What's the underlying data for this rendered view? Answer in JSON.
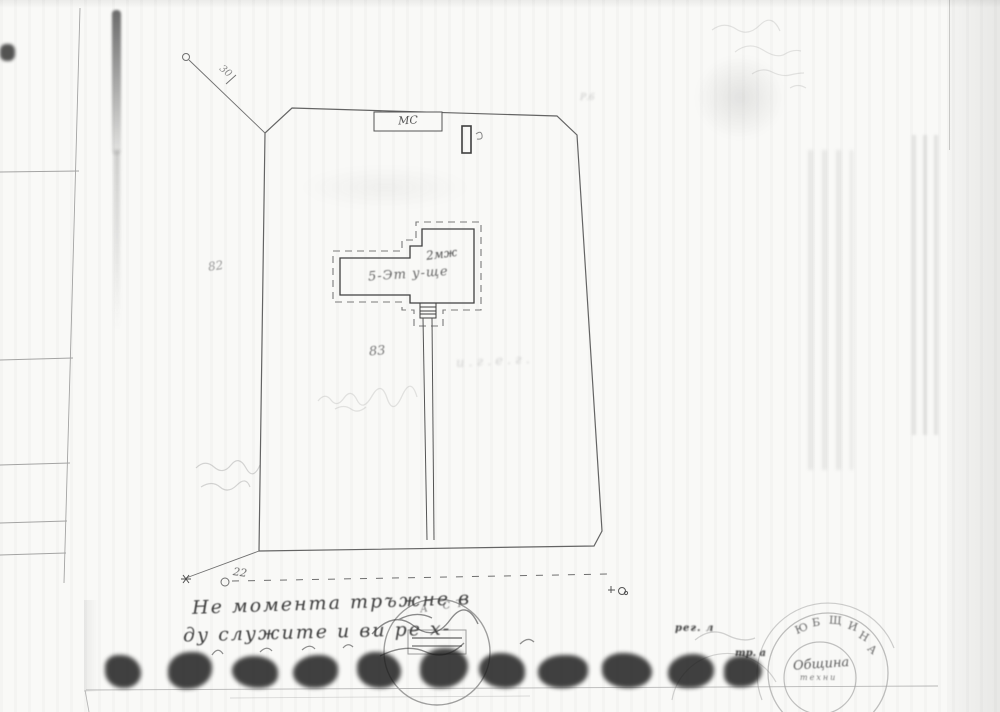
{
  "colors": {
    "paper": "#f9f9f7",
    "ink": "#3f3f3f",
    "faint_ink": "#9a9a9a"
  },
  "plan": {
    "parcel_number_left": "82",
    "parcel_number_center": "83",
    "building_storeys_label": "2мж",
    "building_name_label": "5-Эт у-ще",
    "outbuilding_label": "МС",
    "dimension_top_left": "30",
    "dimension_bottom_left": "22",
    "mark_top_right": "Р.6",
    "faint_label_right_of_path": "и.г.е.г."
  },
  "notes": {
    "line1": "Не момента тръжне в",
    "line2": "ду служите и      ви ре х-"
  },
  "stamps": {
    "center_arc_text": "А СТ",
    "municipal_arc_letters": [
      "Ю",
      "Б",
      "Щ",
      "И",
      "Н",
      "А"
    ],
    "municipal_inner_script": "Община",
    "municipal_inner_small": "техни",
    "fragment_reg": "рег. л",
    "fragment_tra": "тр. а"
  }
}
